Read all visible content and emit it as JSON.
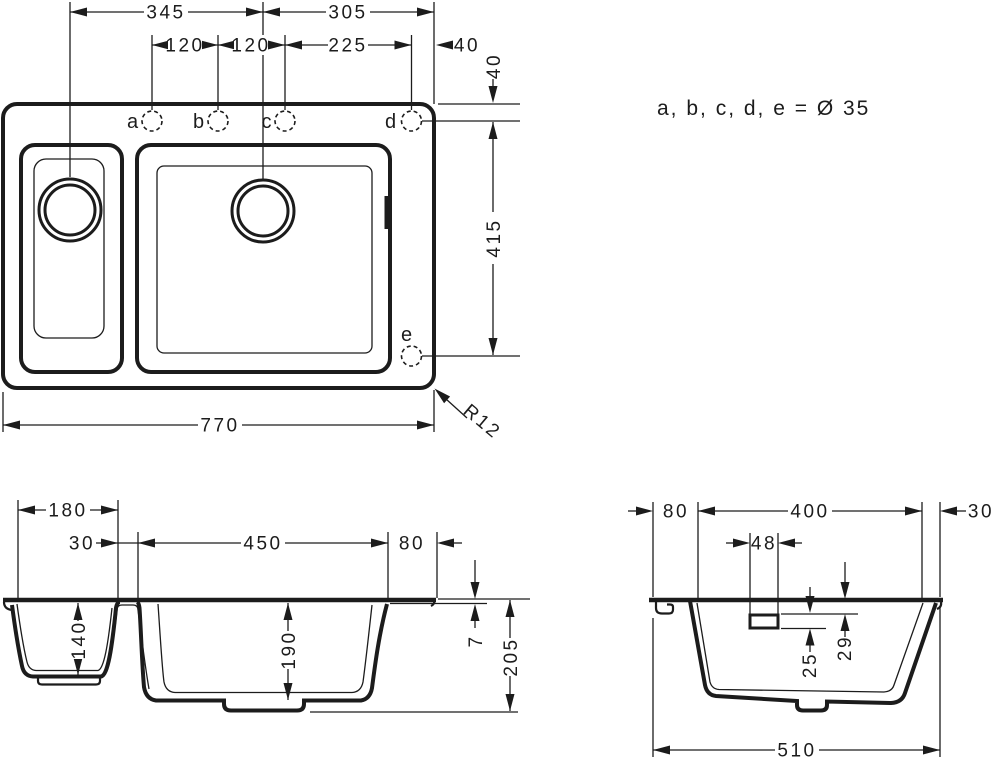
{
  "drawing": {
    "note_label": "a, b, c, d, e = Ø 35",
    "top_view": {
      "dim_345": "345",
      "dim_305": "305",
      "dim_120_ab": "120",
      "dim_120_bc": "120",
      "dim_225": "225",
      "dim_40_right": "40",
      "dim_40_top_edge": "40",
      "dim_415": "415",
      "dim_770": "770",
      "radius_label": "R12",
      "hole_a": "a",
      "hole_b": "b",
      "hole_c": "c",
      "hole_d": "d",
      "hole_e": "e"
    },
    "front_view": {
      "dim_180": "180",
      "dim_30": "30",
      "dim_450": "450",
      "dim_80": "80",
      "dim_140": "140",
      "dim_190": "190",
      "dim_7": "7",
      "dim_205": "205"
    },
    "side_view": {
      "dim_80": "80",
      "dim_400": "400",
      "dim_30": "30",
      "dim_48": "48",
      "dim_29": "29",
      "dim_25": "25",
      "dim_510": "510"
    }
  }
}
